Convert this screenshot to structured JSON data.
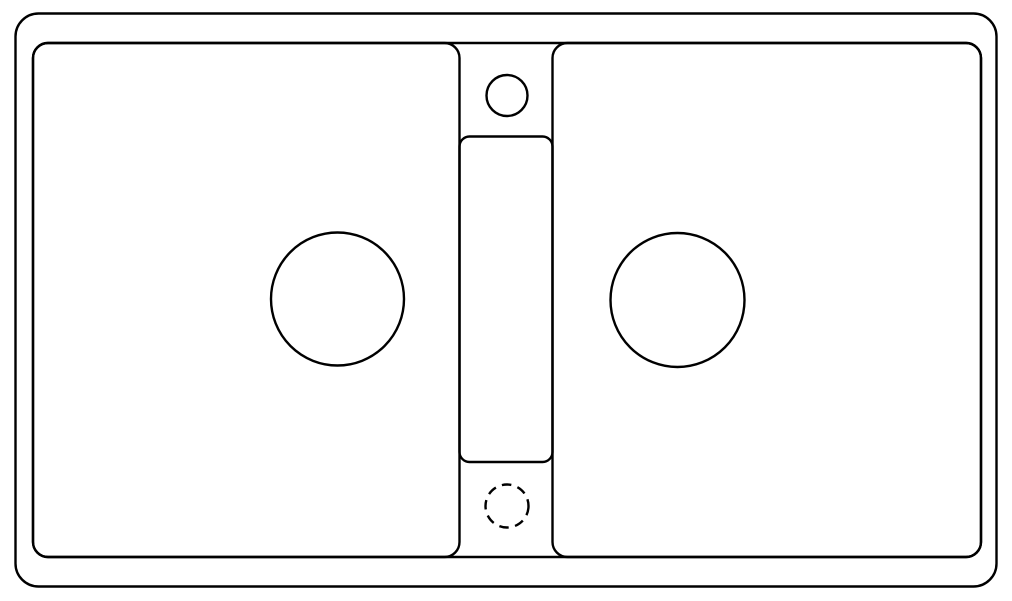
{
  "canvas": {
    "width": 1012,
    "height": 601,
    "background_color": "#ffffff",
    "line_color": "#000000",
    "line_width": 2.4
  },
  "drawing": {
    "subject": "double-bowl-sink-top-view-line-drawing",
    "shapes": [
      {
        "name": "sink-outer-rim-outline",
        "type": "rect",
        "x": 15.5,
        "y": 13.5,
        "w": 981,
        "h": 573,
        "rx": 23
      },
      {
        "name": "sink-inner-deck-outline",
        "type": "rect",
        "x": 33,
        "y": 43,
        "w": 948,
        "h": 514,
        "rx": 15
      },
      {
        "name": "left-bowl-outline",
        "type": "rect",
        "x": 33,
        "y": 43,
        "w": 426.5,
        "h": 514,
        "rx": 15
      },
      {
        "name": "right-bowl-outline",
        "type": "rect",
        "x": 552.5,
        "y": 43,
        "w": 428.5,
        "h": 514,
        "rx": 15
      },
      {
        "name": "center-panel-outline",
        "type": "rect",
        "x": 459.5,
        "y": 136.5,
        "w": 93,
        "h": 325.5,
        "rx": 10
      },
      {
        "name": "tap-hole-circle",
        "type": "circle",
        "cx": 507,
        "cy": 95.5,
        "r": 20.5
      },
      {
        "name": "left-bowl-drain-circle",
        "type": "circle",
        "cx": 337.5,
        "cy": 299,
        "r": 66.5
      },
      {
        "name": "right-bowl-drain-circle",
        "type": "circle",
        "cx": 677.5,
        "cy": 300,
        "r": 67
      },
      {
        "name": "optional-hole-dashed-circle",
        "type": "circle",
        "cx": 507,
        "cy": 506,
        "r": 21.5,
        "dash": "9.5 6.5"
      }
    ]
  }
}
